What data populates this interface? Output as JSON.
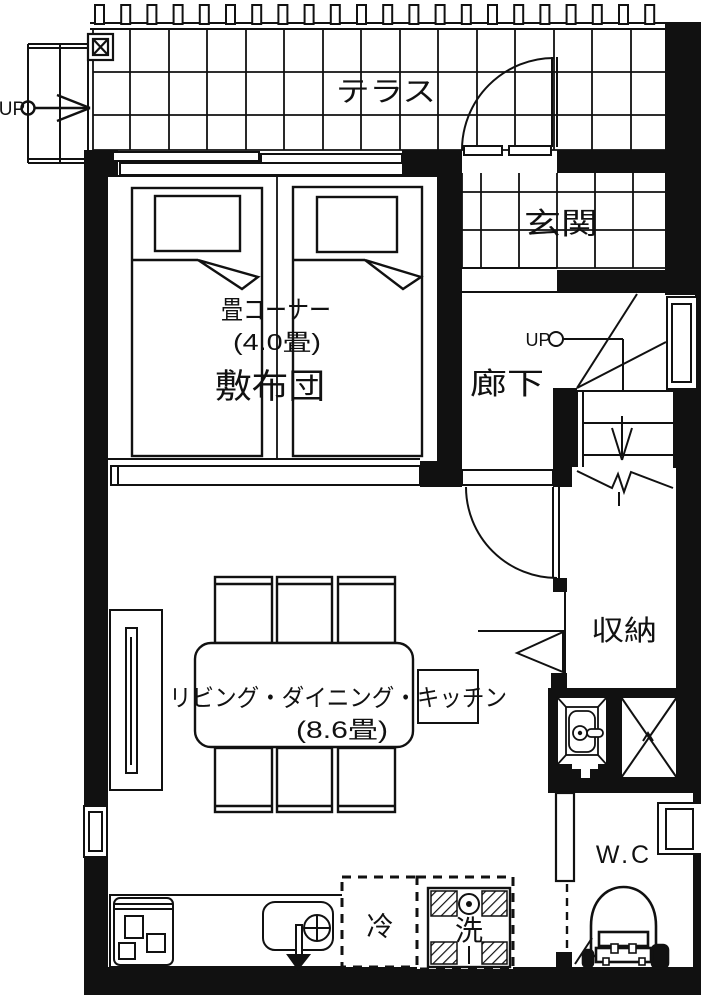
{
  "title": "floor-plan",
  "labels": {
    "terrace": "テラス",
    "entrance": "玄関",
    "tatami_corner": "畳コーナー",
    "tatami_size": "(4.0畳)",
    "futon": "敷布団",
    "hallway": "廊下",
    "up_hall": "UP",
    "up_outside": "UP",
    "storage": "収納",
    "ldk": "リビング・ダイニング・キッチン",
    "ldk_size": "(8.6畳)",
    "fridge": "冷",
    "washer": "洗",
    "wc": "W.C"
  },
  "colors": {
    "line": "#111111",
    "wall": "#111111",
    "background": "#ffffff"
  }
}
